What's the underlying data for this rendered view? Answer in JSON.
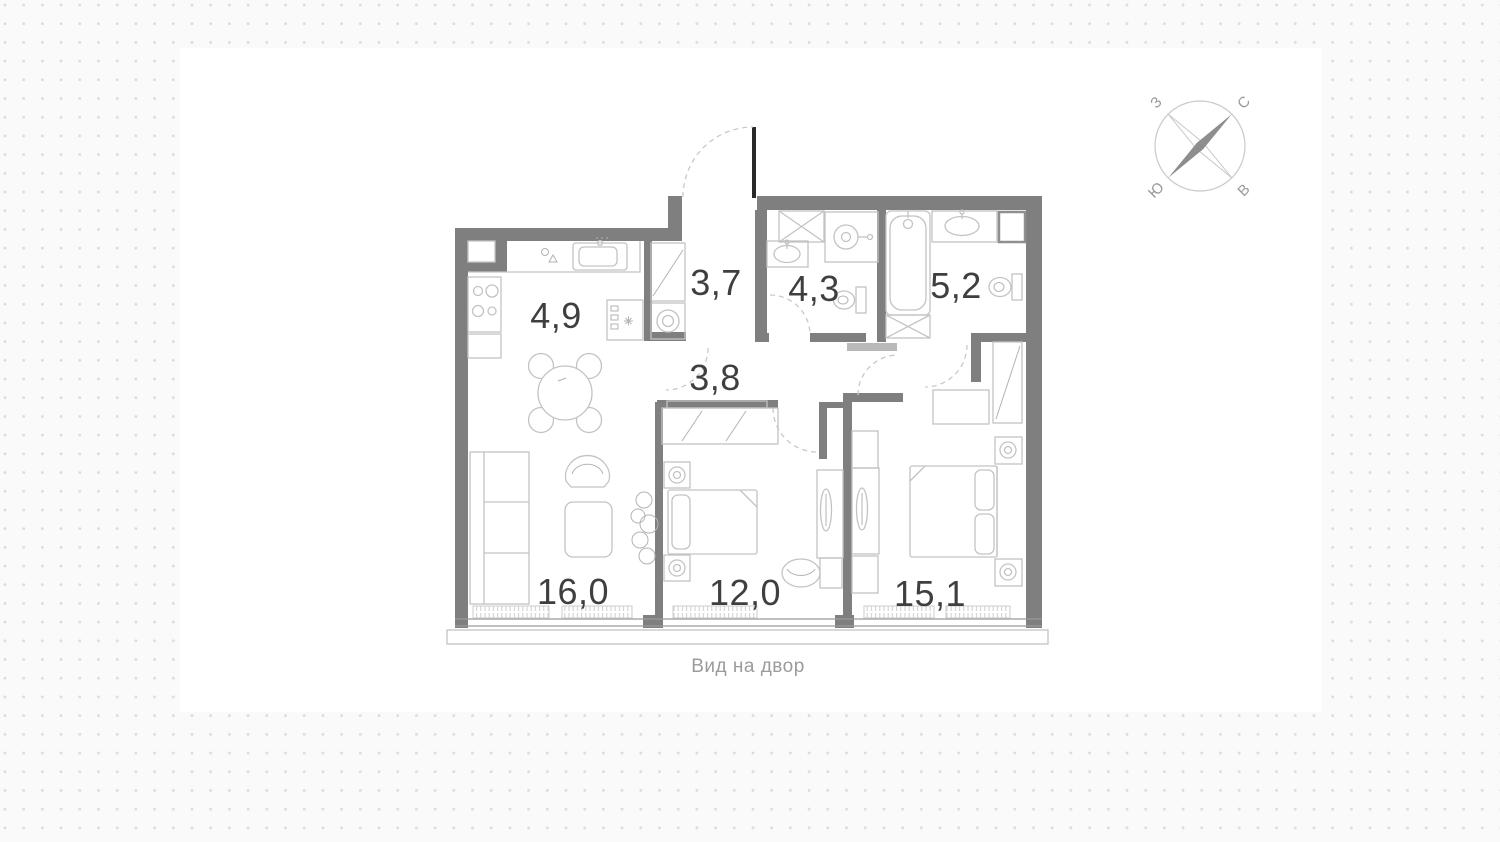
{
  "plan": {
    "caption": "Вид на двор",
    "room_areas": [
      {
        "room": "kitchen",
        "label": "4,9"
      },
      {
        "room": "hallway",
        "label": "3,7"
      },
      {
        "room": "bathroom-1",
        "label": "4,3"
      },
      {
        "room": "bathroom-2",
        "label": "5,2"
      },
      {
        "room": "corridor",
        "label": "3,8"
      },
      {
        "room": "living-room",
        "label": "16,0"
      },
      {
        "room": "bedroom-1",
        "label": "12,0"
      },
      {
        "room": "bedroom-2",
        "label": "15,1"
      }
    ]
  },
  "compass": {
    "n": "С",
    "e": "В",
    "s": "Ю",
    "w": "З"
  },
  "colors": {
    "wall": "#7f7f7f",
    "furniture_line": "#c3c3c3",
    "door_arc": "#c9c9c9",
    "door_leaf": "#2a2a2a",
    "label_text": "#3f3f3f",
    "caption_text": "#9b9b9b",
    "background_dot": "#dcdcdc",
    "panel": "#ffffff"
  }
}
